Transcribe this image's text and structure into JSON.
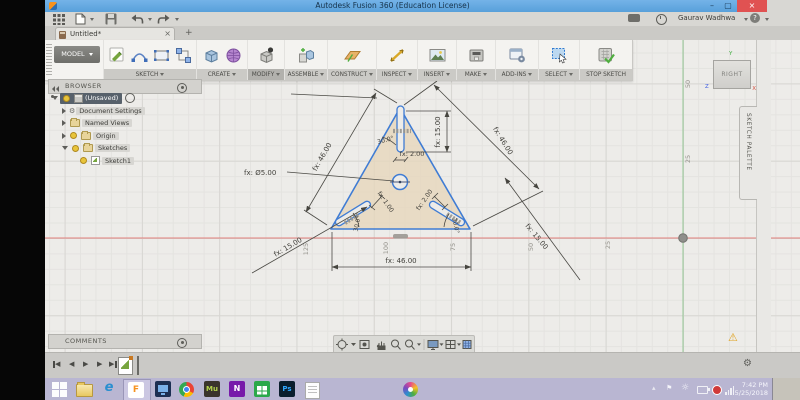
{
  "titlebar": {
    "title": "Autodesk Fusion 360 (Education License)"
  },
  "account": {
    "user": "Gaurav Wadhwa"
  },
  "tabs": {
    "active": "Untitled*"
  },
  "ribbon": {
    "model": "MODEL",
    "groups": [
      "SKETCH",
      "CREATE",
      "MODIFY",
      "ASSEMBLE",
      "CONSTRUCT",
      "INSPECT",
      "INSERT",
      "MAKE",
      "ADD-INS",
      "SELECT",
      "STOP SKETCH"
    ]
  },
  "browser": {
    "header": "BROWSER",
    "root": "(Unsaved)",
    "items": [
      "Document Settings",
      "Named Views",
      "Origin",
      "Sketches"
    ],
    "sketch": "Sketch1"
  },
  "viewcube": {
    "face": "RIGHT",
    "x": "X",
    "y": "Y",
    "z": "Z"
  },
  "palette": {
    "label": "SKETCH PALETTE"
  },
  "comments": {
    "header": "COMMENTS"
  },
  "dims": {
    "left46": "fx: 46.00",
    "right46": "fx: 46.00",
    "slot15": "fx: 15.00",
    "angle_top": "30.0°",
    "slotw2": "fx: 2.00",
    "circle5": "fx: Ø5.00",
    "bl1": "fx: 1.00",
    "angle_bl": "30.0°",
    "br2": "fx: 2.00",
    "angle_br": "30.0°",
    "base46": "fx: 46.00",
    "bl15": "fx: 15.00",
    "br15": "fx: 15.00"
  },
  "grid": {
    "x": [
      "125",
      "100",
      "75",
      "50",
      "25"
    ],
    "y": [
      "50",
      "25"
    ]
  },
  "taskbar": {
    "time": "7:42 PM",
    "date": "5/25/2018",
    "ie": "e",
    "fusion": "F",
    "muse": "Mu",
    "onenote": "N",
    "ps": "Ps"
  },
  "icons": {
    "chevron": "▾",
    "close": "×",
    "add": "+",
    "gear": "⚙",
    "warning": "⚠",
    "flag": "⚑",
    "sun": "☼",
    "up": "▴",
    "left": "◀",
    "right": "▶",
    "help": "?"
  }
}
